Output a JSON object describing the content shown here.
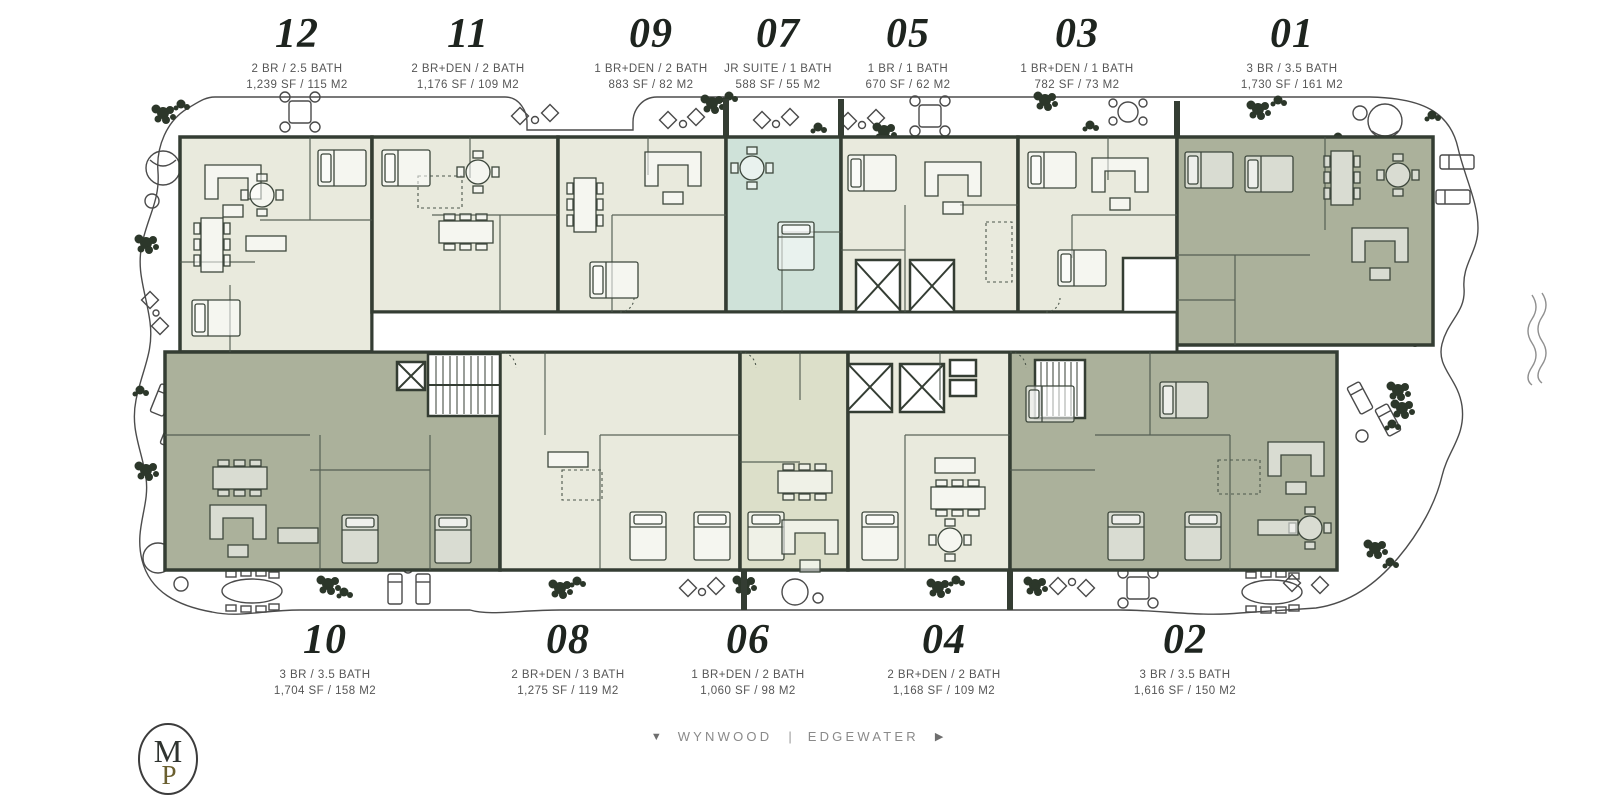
{
  "units_top": [
    {
      "number": "12",
      "type": "2 BR / 2.5 BATH",
      "size": "1,239 SF / 115 M2"
    },
    {
      "number": "11",
      "type": "2 BR+DEN / 2 BATH",
      "size": "1,176 SF / 109 M2"
    },
    {
      "number": "09",
      "type": "1 BR+DEN / 2 BATH",
      "size": "883 SF / 82 M2"
    },
    {
      "number": "07",
      "type": "JR SUITE / 1 BATH",
      "size": "588 SF / 55 M2"
    },
    {
      "number": "05",
      "type": "1 BR / 1 BATH",
      "size": "670 SF / 62 M2"
    },
    {
      "number": "03",
      "type": "1 BR+DEN / 1 BATH",
      "size": "782 SF / 73 M2"
    },
    {
      "number": "01",
      "type": "3 BR / 3.5 BATH",
      "size": "1,730 SF / 161 M2"
    }
  ],
  "units_bottom": [
    {
      "number": "10",
      "type": "3 BR / 3.5 BATH",
      "size": "1,704 SF / 158 M2"
    },
    {
      "number": "08",
      "type": "2 BR+DEN / 3 BATH",
      "size": "1,275 SF / 119 M2"
    },
    {
      "number": "06",
      "type": "1 BR+DEN / 2 BATH",
      "size": "1,060 SF / 98 M2"
    },
    {
      "number": "04",
      "type": "2 BR+DEN / 2 BATH",
      "size": "1,168 SF / 109 M2"
    },
    {
      "number": "02",
      "type": "3 BR / 3.5 BATH",
      "size": "1,616 SF / 150 M2"
    }
  ],
  "footer": {
    "area_left": "WYNWOOD",
    "separator": "|",
    "area_right": "EDGEWATER"
  },
  "icons": {
    "nav_down": "▼",
    "nav_next": "▶"
  },
  "logo": {
    "letter_top": "M",
    "letter_bottom": "P"
  },
  "colors": {
    "wall": "#343d33",
    "unit_light": "#e9eadd",
    "unit_dark": "#abb19b",
    "unit_teal": "#cfe2d9",
    "unit_mid": "#dcdfc9",
    "corridor": "#ffffff"
  }
}
